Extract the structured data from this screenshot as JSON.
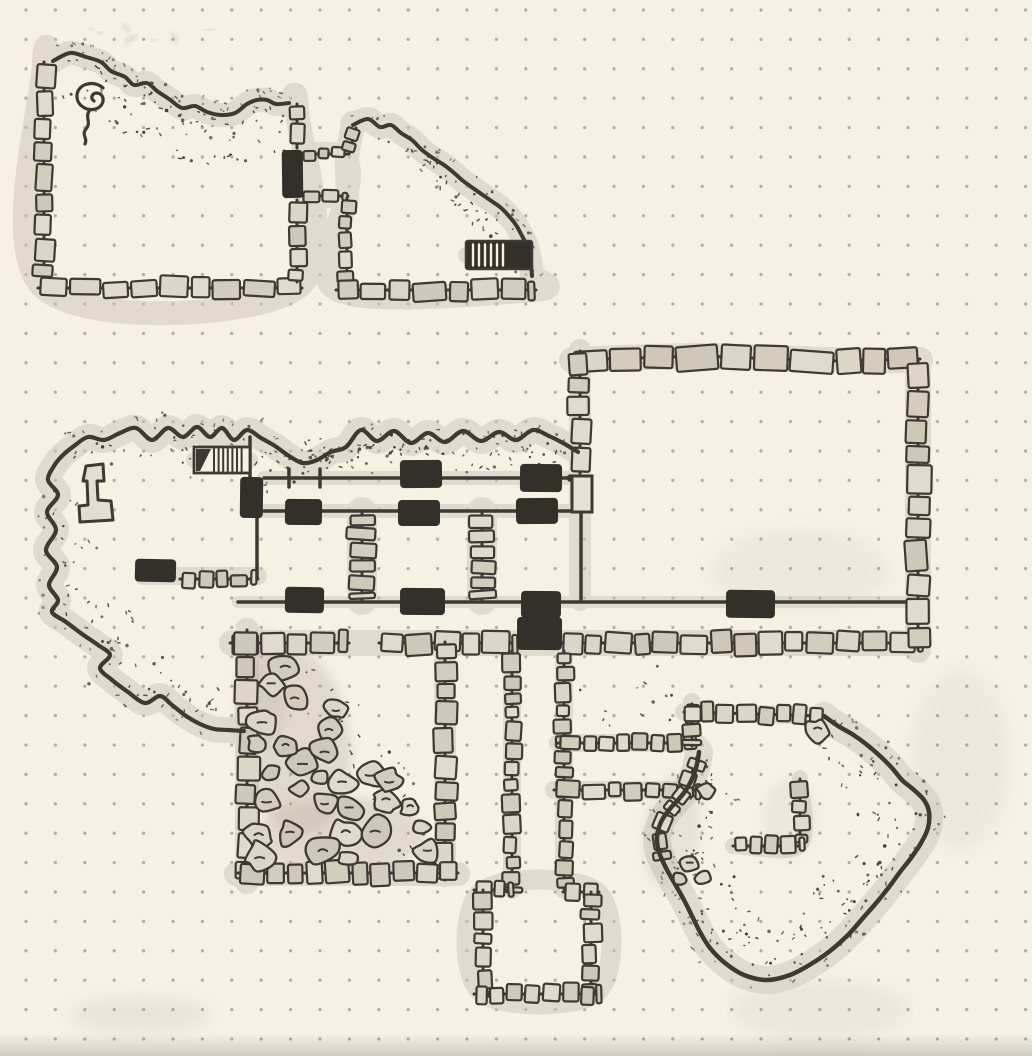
{
  "artwork": {
    "kind": "hand-drawn dungeon map",
    "medium": "ink and marker on cream dot-grid notebook paper",
    "aria_label": "Hand-drawn fantasy dungeon map in black ink on cream dot-grid paper: stone-walled rooms and corridors connected by black door markers, two hatched stairways, two stippled natural caverns, and a chamber filled with rubble"
  },
  "palette": {
    "paper": "#f5f1e3",
    "grid_dot": "#b3ac9d",
    "ink": "#3d3933",
    "door_fill": "#33302a",
    "stone_fill_variants": [
      "#ddd6c8",
      "#d4ccbd",
      "#e1dbcd",
      "#cfc7b8"
    ],
    "halo": "#cfc4ba",
    "rubble_shade": "#b4a699",
    "ghost_mark": "#8f8f98",
    "hatch_white": "#f4f0e2"
  },
  "grid": {
    "pitch_px": 29.4,
    "offset_x": 24,
    "offset_y": 8,
    "dot_radius": 1.6
  },
  "legend": {
    "door_icon": "solid black rectangle",
    "stairs_icon": "hatched rectangle",
    "wall_icon": "stone block masonry",
    "cave_icon": "stippled irregular outline",
    "rubble_icon": "pile of irregular stones"
  },
  "counts": {
    "door_markers": 13,
    "stairways": 2
  }
}
